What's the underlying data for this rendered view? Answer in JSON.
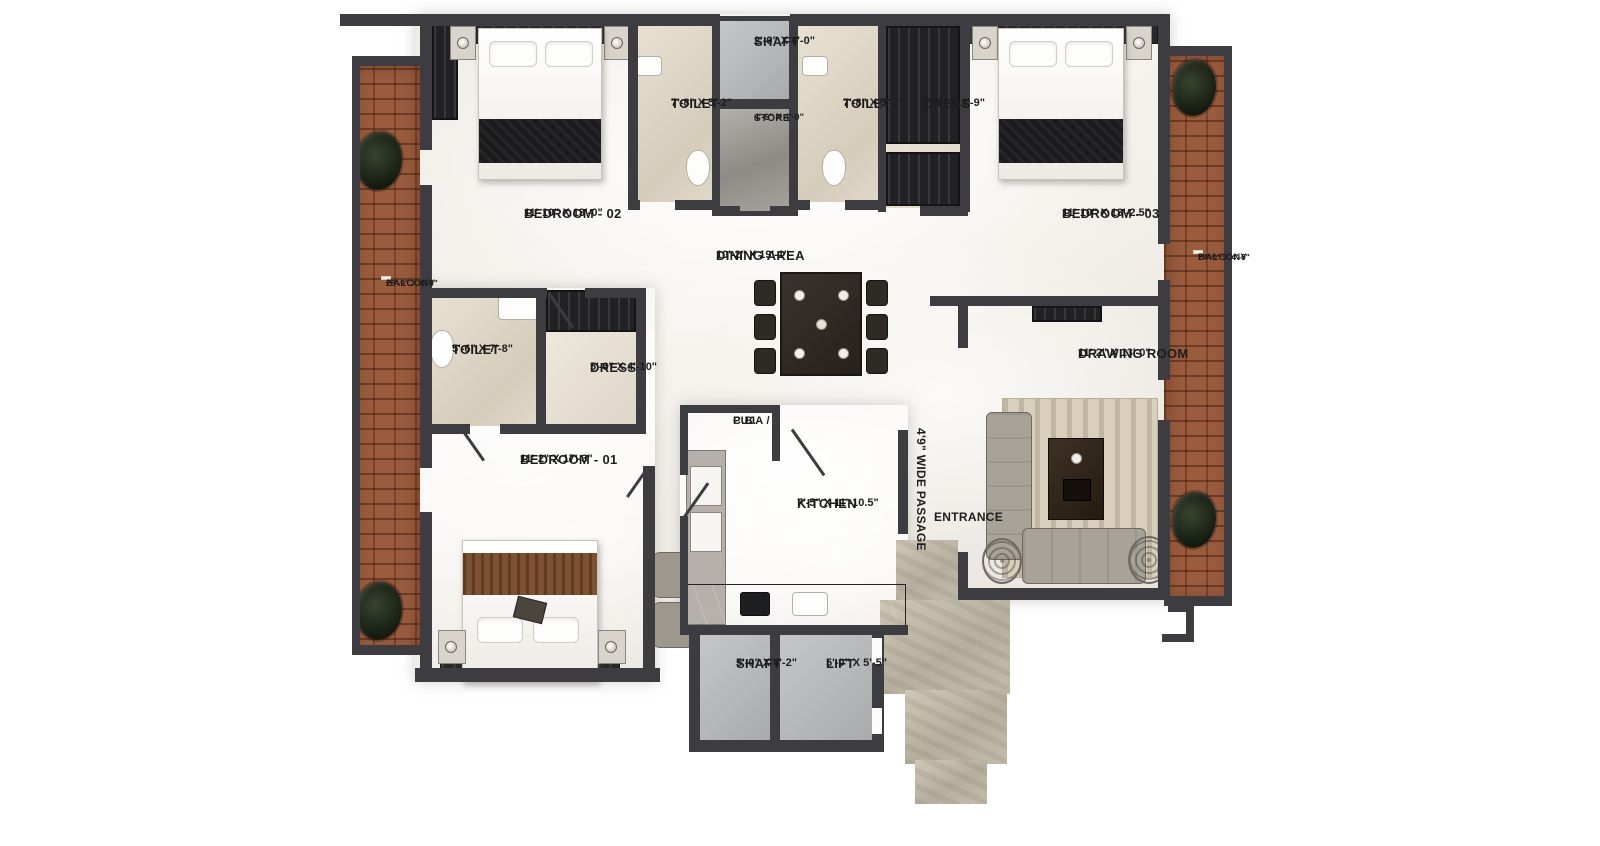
{
  "rooms": {
    "balcony_left": {
      "name": "BALCONY",
      "dims": "28'-9\" X 4'-0\""
    },
    "balcony_right": {
      "name": "BALCONY",
      "dims": "24'-0\" X 4'-0\""
    },
    "shaft_top": {
      "name": "SHAFT",
      "dims": "2'-9\" X 4'-0\""
    },
    "toilet_top_left": {
      "name": "TOILET",
      "dims": "7'-8\" X 5'-2\""
    },
    "store": {
      "name": "STORE",
      "dims": "4'-6\" X 4'-0\""
    },
    "toilet_top_right": {
      "name": "TOILET",
      "dims": "7'-8\" X 5'-3\""
    },
    "dress_top": {
      "name": "DRESS",
      "dims": "7'-8\" X 3'-9\""
    },
    "bedroom_02": {
      "name": "BEDROOM - 02",
      "dims": "11'-10\" X 13'-0\""
    },
    "bedroom_03": {
      "name": "BEDROOM - 03",
      "dims": "11'-10\" X 13'-2.5\""
    },
    "dining": {
      "name": "DINING AREA",
      "dims": "10'-2\" X 19'-1\""
    },
    "toilet_mid": {
      "name": "TOILET",
      "dims": "5'-6\" X 7'-8\""
    },
    "dress_mid": {
      "name": "DRESS",
      "dims": "5'-6\" X 4'-10\""
    },
    "bedroom_01": {
      "name": "BEDROOM - 01",
      "dims": "11'-2\" X 17'-3\""
    },
    "puja": {
      "line1": "PUJA /",
      "line2": "C.B."
    },
    "kitchen": {
      "name": "KITCHEN",
      "dims": "7'-5\" X 11'-10.5\""
    },
    "drawing_room": {
      "name": "DRAWING ROOM",
      "dims": "11'-2\" X 13'-0\""
    },
    "passage": {
      "name": "4'9\" WIDE PASSAGE"
    },
    "entrance": {
      "name": "ENTRANCE"
    },
    "shaft_bottom": {
      "name": "SHAFT",
      "dims": "5'-0\" X 4'-2\""
    },
    "lift": {
      "name": "LIFT",
      "dims": "5'-0\" X 5'-5\""
    }
  },
  "colors": {
    "wall": "#3c3c41",
    "floor": "#f3f0ea",
    "brick": "#9a5c3d",
    "graybox": "#bcbdbf",
    "stone": "#c6beac",
    "text": "#1d1d1d"
  }
}
